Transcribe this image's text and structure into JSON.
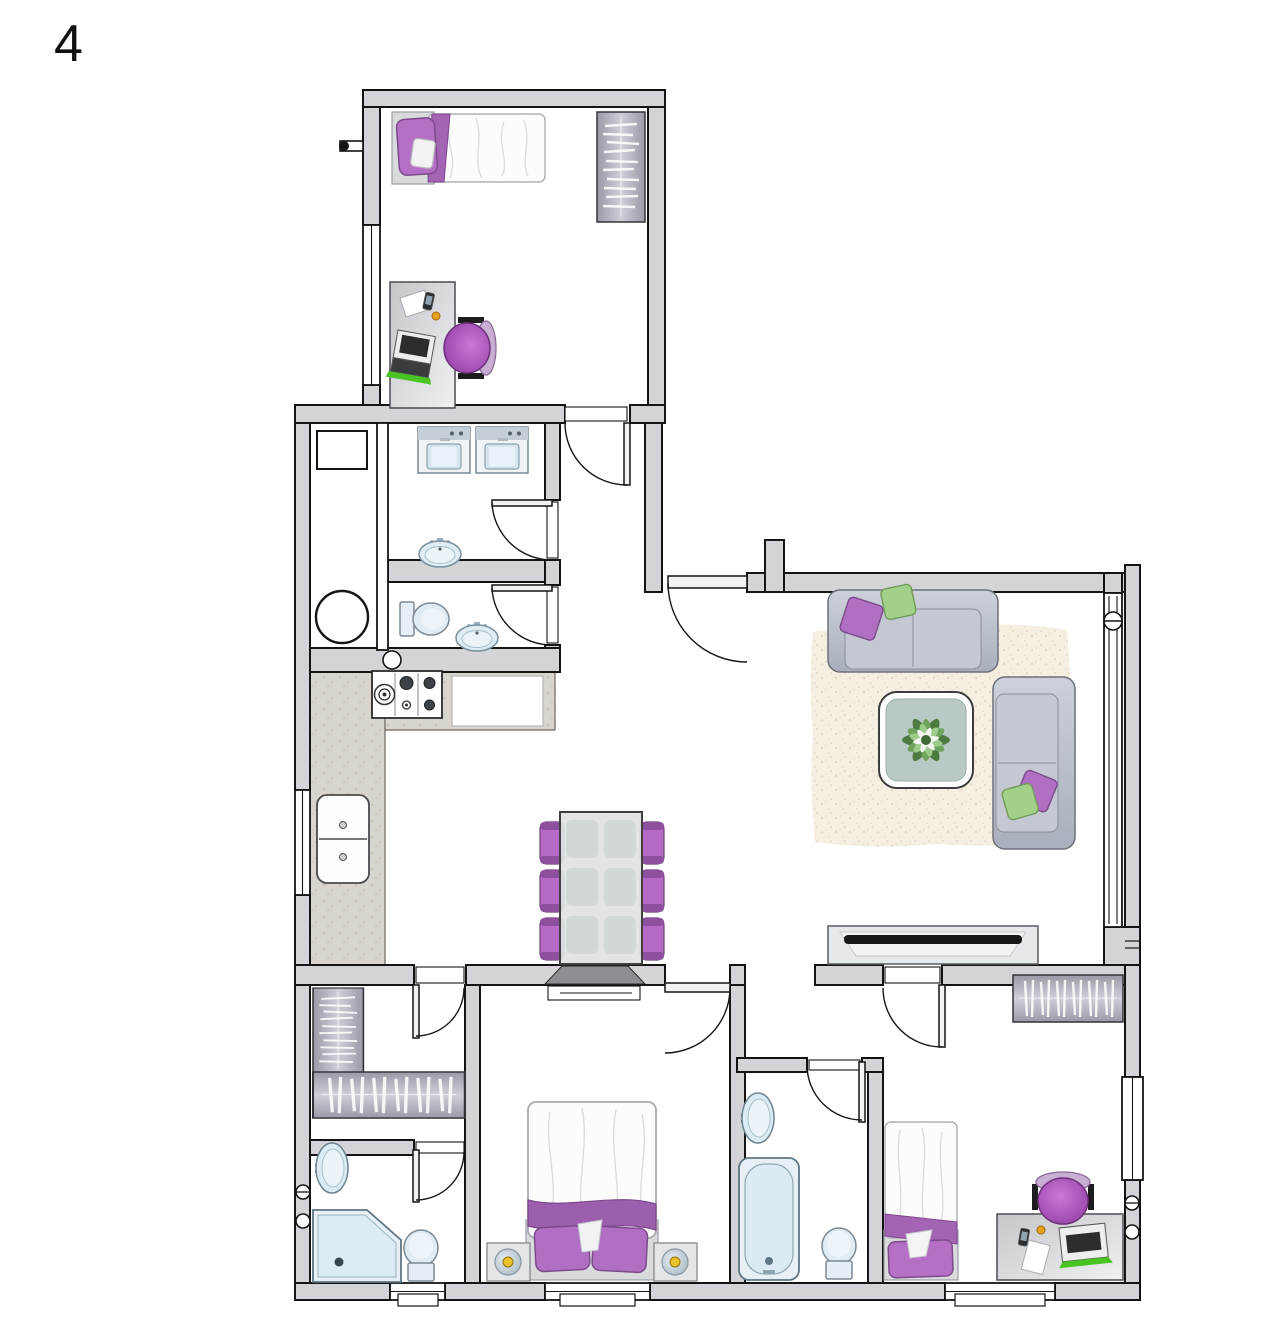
{
  "page": {
    "floor_label": "4",
    "type": "apartment-floor-plan",
    "background": "#ffffff"
  },
  "colors": {
    "wall_fill": "#d4d4d8",
    "outline": "#141414",
    "fixture_fill": "#dfecf3",
    "fixture_stroke": "#6d8593",
    "purple": "#b06fc2",
    "purple_dark": "#7d4b8c",
    "green_pillow": "#a3d089",
    "sofa_fill": "#bcc2ce",
    "counter_fill": "#d8d5cf",
    "rug_fill": "#f5efe2",
    "lamp_yellow": "#e8c12b",
    "laptop_green": "#49c421",
    "accent_orange": "#e8a21f"
  },
  "plan": {
    "rooms": [
      {
        "id": "bedroom-top",
        "contents": [
          "single-bed",
          "wardrobe",
          "desk",
          "office-chair",
          "window"
        ]
      },
      {
        "id": "hall",
        "contents": [
          "entrance-area"
        ]
      },
      {
        "id": "utility-room",
        "contents": [
          "boiler",
          "wall-cabinet"
        ]
      },
      {
        "id": "laundry",
        "contents": [
          "washing-machine",
          "washing-machine",
          "sink"
        ]
      },
      {
        "id": "wc",
        "contents": [
          "toilet",
          "sink"
        ]
      },
      {
        "id": "kitchen-dining",
        "contents": [
          "l-counter",
          "stove",
          "double-sink",
          "dining-table",
          "six-chairs"
        ]
      },
      {
        "id": "living-room",
        "contents": [
          "rug",
          "sofa",
          "sofa",
          "coffee-table-with-plant",
          "tv",
          "glass-wall"
        ]
      },
      {
        "id": "corridor",
        "contents": []
      },
      {
        "id": "walk-in-closet",
        "contents": [
          "l-wardrobe"
        ]
      },
      {
        "id": "ensuite-bathroom",
        "contents": [
          "round-sink",
          "corner-shower",
          "toilet"
        ]
      },
      {
        "id": "master-bedroom",
        "contents": [
          "double-bed",
          "nightstand",
          "nightstand",
          "window"
        ]
      },
      {
        "id": "bathroom",
        "contents": [
          "sink",
          "bathtub",
          "toilet"
        ]
      },
      {
        "id": "bedroom-bottom",
        "contents": [
          "single-bed",
          "wardrobe",
          "desk",
          "office-chair",
          "window"
        ]
      }
    ]
  },
  "furniture": [
    {
      "name": "boiler",
      "symbol": "sym-boiler",
      "transform": "translate(315,590)"
    },
    {
      "name": "wall-cabinet",
      "symbol": "sym-cabinet",
      "transform": "translate(317,431)"
    },
    {
      "name": "washing-machine-1",
      "symbol": "sym-washer",
      "transform": "translate(418,427)"
    },
    {
      "name": "washing-machine-2",
      "symbol": "sym-washer",
      "transform": "translate(476,427)"
    },
    {
      "name": "laundry-sink",
      "symbol": "sym-sink-oval",
      "transform": "translate(418,538)"
    },
    {
      "name": "wc-toilet",
      "symbol": "sym-toilet-right",
      "transform": "translate(400,598)"
    },
    {
      "name": "wc-sink",
      "symbol": "sym-sink-oval",
      "transform": "translate(455,622)"
    },
    {
      "name": "stove",
      "symbol": "sym-stove",
      "transform": "translate(372,671)"
    },
    {
      "name": "kitchen-sink",
      "symbol": "sym-ksink",
      "transform": "translate(317,795)"
    },
    {
      "name": "dining-set",
      "symbol": "sym-dining",
      "transform": "translate(540,812)"
    },
    {
      "name": "living-rug",
      "symbol": "sym-rug",
      "transform": "translate(805,618)"
    },
    {
      "name": "sofa-top",
      "symbol": "sym-sofa-h",
      "transform": "translate(828,590)"
    },
    {
      "name": "sofa-right",
      "symbol": "sym-sofa-v",
      "transform": "translate(993,677)"
    },
    {
      "name": "coffee-table-plant",
      "symbol": "sym-coffee-table",
      "transform": "translate(879,692)"
    },
    {
      "name": "tv-unit",
      "symbol": "sym-tv",
      "transform": "translate(828,926)"
    },
    {
      "name": "wardrobe-top-bedroom",
      "symbol": "sym-wardrobe-v",
      "transform": "translate(597,112)"
    },
    {
      "name": "bed-top-bedroom",
      "symbol": "sym-bed-single-h",
      "transform": "translate(392,112)"
    },
    {
      "name": "desk-top-bedroom",
      "symbol": "sym-desk-v",
      "transform": "translate(390,282)"
    },
    {
      "name": "chair-top-bedroom",
      "symbol": "sym-office-chair",
      "transform": "translate(470,348) rotate(90)"
    },
    {
      "name": "closet-wardrobe-vertical",
      "symbol": "sym-wardrobe-v",
      "transform": "translate(313,988) scale(1.05,0.78)"
    },
    {
      "name": "closet-wardrobe-horizontal",
      "symbol": "sym-wardrobe-h",
      "transform": "translate(313,1072) scale(1.38,0.98)"
    },
    {
      "name": "wardrobe-bottom-bedroom",
      "symbol": "sym-wardrobe-h",
      "transform": "translate(1013,975)"
    },
    {
      "name": "master-bed",
      "symbol": "sym-double-bed",
      "transform": "translate(526,1102)"
    },
    {
      "name": "nightstand-left",
      "symbol": "sym-nightstand",
      "transform": "translate(487,1243)"
    },
    {
      "name": "nightstand-right",
      "symbol": "sym-nightstand",
      "transform": "translate(654,1243)"
    },
    {
      "name": "bed-bottom-bedroom",
      "symbol": "sym-bed-single-v",
      "transform": "translate(884,1122)"
    },
    {
      "name": "desk-bottom-bedroom",
      "symbol": "sym-desk-h",
      "transform": "translate(997,1214)"
    },
    {
      "name": "chair-bottom-bedroom",
      "symbol": "sym-office-chair",
      "transform": "translate(1063,1198)"
    },
    {
      "name": "bathtub",
      "symbol": "sym-tub",
      "transform": "translate(739,1158)"
    },
    {
      "name": "bathroom-toilet",
      "symbol": "sym-toilet-up",
      "transform": "translate(821,1228)"
    },
    {
      "name": "bathroom-sink",
      "symbol": "sym-sink-round",
      "transform": "translate(741,1092)"
    },
    {
      "name": "ensuite-toilet",
      "symbol": "sym-toilet-up",
      "transform": "translate(403,1230)"
    },
    {
      "name": "ensuite-sink",
      "symbol": "sym-sink-round",
      "transform": "translate(315,1142)"
    },
    {
      "name": "corner-shower",
      "symbol": "sym-shower",
      "transform": "translate(313,1210)"
    }
  ]
}
